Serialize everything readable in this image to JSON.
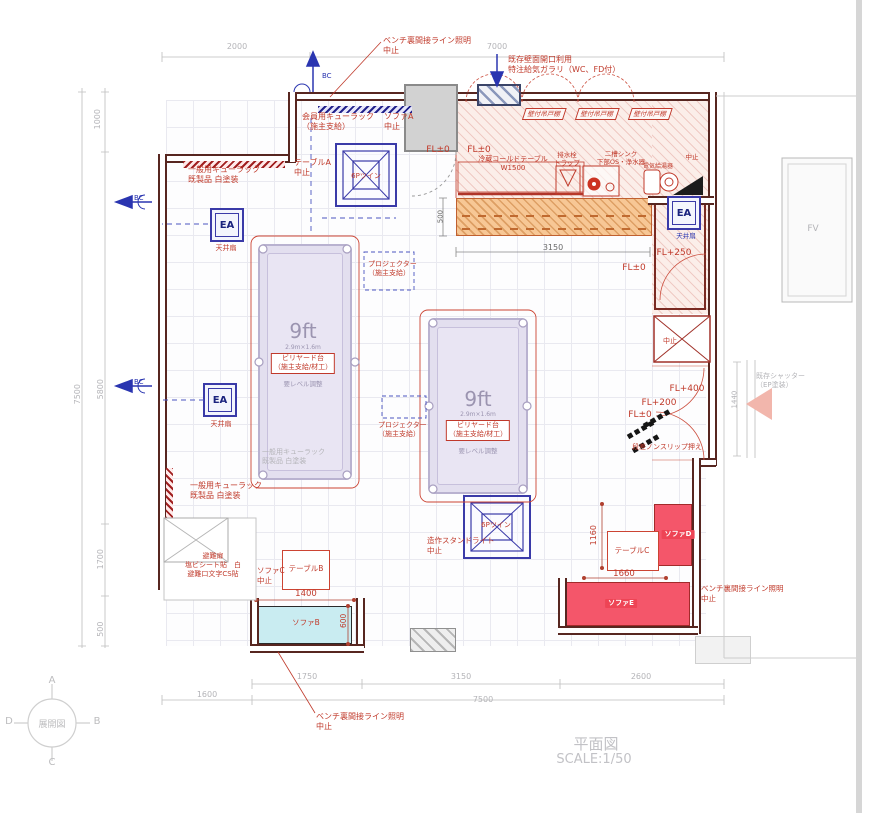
{
  "drawing": {
    "title": "平面図",
    "scale": "SCALE:1/50"
  },
  "compass": {
    "center": "展開図",
    "top": "A",
    "right": "B",
    "bottom": "C",
    "left": "D"
  },
  "symbols": {
    "ea": "EA"
  },
  "colors": {
    "red": "#c03a2b",
    "blue": "#2a35b0",
    "grey": "#b4b4b8",
    "purple": "#9b94b0",
    "dark": "#6a6a6a",
    "white": "#ffffff",
    "wall": "#572620"
  },
  "annotations": [
    {
      "name": "note-bench-light-top",
      "t": "ベンチ裏間接ライン照明\n中止",
      "x": 383,
      "y": 36,
      "c": "red",
      "fs": 8,
      "al": "l"
    },
    {
      "name": "note-vent",
      "t": "既存壁面開口利用\n特注給気ガラリ（WC、FD付）",
      "x": 508,
      "y": 55,
      "c": "red",
      "fs": 8,
      "al": "l"
    },
    {
      "name": "note-cue-member",
      "t": "会員用キューラック\n（施主支給）",
      "x": 302,
      "y": 112,
      "c": "red",
      "fs": 8,
      "al": "l"
    },
    {
      "name": "note-sofa-a",
      "t": "ソファA\n中止",
      "x": 384,
      "y": 112,
      "c": "red",
      "fs": 8,
      "al": "l"
    },
    {
      "name": "note-table-a",
      "t": "テーブルA\n中止",
      "x": 294,
      "y": 158,
      "c": "red",
      "fs": 8,
      "al": "l"
    },
    {
      "name": "label-light-1",
      "t": "6Pツイン",
      "x": 366,
      "y": 172,
      "c": "red",
      "fs": 7
    },
    {
      "name": "note-cue-general-top",
      "t": "一般用キューラック\n既製品 白塗装",
      "x": 188,
      "y": 165,
      "c": "red",
      "fs": 8,
      "al": "l"
    },
    {
      "name": "label-bc-top",
      "t": "BC",
      "x": 322,
      "y": 72,
      "c": "blue",
      "fs": 7,
      "al": "l"
    },
    {
      "name": "label-bc-left-1",
      "t": "BC",
      "x": 134,
      "y": 194,
      "c": "blue",
      "fs": 7,
      "al": "l"
    },
    {
      "name": "label-bc-left-2",
      "t": "BC",
      "x": 134,
      "y": 378,
      "c": "blue",
      "fs": 7,
      "al": "l"
    },
    {
      "name": "label-ceiling-fan-1",
      "t": "天井扇",
      "x": 226,
      "y": 244,
      "c": "red",
      "fs": 7
    },
    {
      "name": "label-ceiling-fan-2",
      "t": "天井扇",
      "x": 221,
      "y": 420,
      "c": "red",
      "fs": 7
    },
    {
      "name": "label-ceiling-fan-3",
      "t": "天井扇",
      "x": 686,
      "y": 232,
      "c": "blue",
      "fs": 6.5
    },
    {
      "name": "label-fl0-entry",
      "t": "FL±0",
      "x": 438,
      "y": 145,
      "c": "red",
      "fs": 9
    },
    {
      "name": "label-fl0-kitchen",
      "t": "FL±0",
      "x": 479,
      "y": 145,
      "c": "red",
      "fs": 9
    },
    {
      "name": "label-cold-table",
      "t": "冷蔵コールドテーブル\nW1500",
      "x": 513,
      "y": 155,
      "c": "red",
      "fs": 7
    },
    {
      "name": "label-cabinet-1",
      "t": "壁付吊戸棚",
      "x": 544,
      "y": 108,
      "c": "red",
      "fs": 6.5,
      "cls": "cab"
    },
    {
      "name": "label-cabinet-2",
      "t": "壁付吊戸棚",
      "x": 597,
      "y": 108,
      "c": "red",
      "fs": 6.5,
      "cls": "cab"
    },
    {
      "name": "label-cabinet-3",
      "t": "壁付吊戸棚",
      "x": 650,
      "y": 108,
      "c": "red",
      "fs": 6.5,
      "cls": "cab"
    },
    {
      "name": "label-drain-trap",
      "t": "排水栓\nトラップ",
      "x": 567,
      "y": 151,
      "c": "red",
      "fs": 6.5
    },
    {
      "name": "label-sink",
      "t": "二槽シンク\n下部OS・浄水器",
      "x": 621,
      "y": 150,
      "c": "red",
      "fs": 6.5
    },
    {
      "name": "label-water-heater",
      "t": "電気給湯器",
      "x": 658,
      "y": 163,
      "c": "red",
      "fs": 6
    },
    {
      "name": "note-stop-topright",
      "t": "中止",
      "x": 692,
      "y": 153,
      "c": "red",
      "fs": 6.5
    },
    {
      "name": "label-fl250",
      "t": "FL+250",
      "x": 674,
      "y": 248,
      "c": "red",
      "fs": 9
    },
    {
      "name": "label-fl0-mid",
      "t": "FL±0",
      "x": 634,
      "y": 263,
      "c": "red",
      "fs": 9
    },
    {
      "name": "dim-3150-counter",
      "t": "3150",
      "x": 553,
      "y": 243,
      "c": "dark",
      "fs": 8
    },
    {
      "name": "dim-500-counter",
      "t": "500",
      "x": 441,
      "y": 212,
      "c": "dark",
      "fs": 7,
      "rot": -90
    },
    {
      "name": "note-projector-1",
      "t": "プロジェクター\n（施主支給）",
      "x": 368,
      "y": 260,
      "c": "red",
      "fs": 7,
      "al": "l"
    },
    {
      "name": "note-projector-2",
      "t": "プロジェクター\n（施主支給）",
      "x": 378,
      "y": 421,
      "c": "red",
      "fs": 7,
      "al": "l"
    },
    {
      "name": "table1-9ft",
      "t": "9ft",
      "x": 303,
      "y": 318,
      "c": "purple",
      "fs": 20
    },
    {
      "name": "table1-size",
      "t": "2.9m×1.6m",
      "x": 303,
      "y": 344,
      "c": "purple",
      "fs": 6
    },
    {
      "name": "table1-badge",
      "t": "ビリヤード台\n（施主支給/材工）",
      "x": 303,
      "y": 353,
      "c": "red",
      "fs": 7,
      "cls": "badge"
    },
    {
      "name": "table1-level",
      "t": "要レベル調整",
      "x": 303,
      "y": 380,
      "c": "purple",
      "fs": 6.5
    },
    {
      "name": "table2-9ft",
      "t": "9ft",
      "x": 478,
      "y": 386,
      "c": "purple",
      "fs": 20
    },
    {
      "name": "table2-size",
      "t": "2.9m×1.6m",
      "x": 478,
      "y": 411,
      "c": "purple",
      "fs": 6
    },
    {
      "name": "table2-badge",
      "t": "ビリヤード台\n（施主支給/材工）",
      "x": 478,
      "y": 420,
      "c": "red",
      "fs": 7,
      "cls": "badge"
    },
    {
      "name": "table2-level",
      "t": "要レベル調整",
      "x": 478,
      "y": 447,
      "c": "purple",
      "fs": 6.5
    },
    {
      "name": "note-cue-grey-mid",
      "t": "一般用キューラック\n既製品 白塗装",
      "x": 262,
      "y": 448,
      "c": "grey",
      "fs": 7,
      "al": "l"
    },
    {
      "name": "label-fl400",
      "t": "FL+400",
      "x": 687,
      "y": 384,
      "c": "red",
      "fs": 9
    },
    {
      "name": "label-fl200",
      "t": "FL+200",
      "x": 659,
      "y": 398,
      "c": "red",
      "fs": 9
    },
    {
      "name": "label-fl0-stair",
      "t": "FL±0",
      "x": 640,
      "y": 410,
      "c": "red",
      "fs": 9
    },
    {
      "name": "label-nonslip",
      "t": "段差ノンスリップ押え",
      "x": 667,
      "y": 443,
      "c": "red",
      "fs": 7
    },
    {
      "name": "note-shutter",
      "t": "既存シャッター\n（EP塗装）",
      "x": 756,
      "y": 372,
      "c": "grey",
      "fs": 7,
      "al": "l"
    },
    {
      "name": "dim-1440",
      "t": "1440",
      "x": 735,
      "y": 395,
      "c": "grey",
      "fs": 7,
      "rot": -90
    },
    {
      "name": "label-fv",
      "t": "FV",
      "x": 813,
      "y": 224,
      "c": "grey",
      "fs": 9
    },
    {
      "name": "note-cue-general-bottom",
      "t": "一般用キューラック\n既製品 白塗装",
      "x": 190,
      "y": 481,
      "c": "red",
      "fs": 8,
      "al": "l"
    },
    {
      "name": "note-escape-door",
      "t": "避難扉\n塩ビシート貼　白\n避難口文字CS貼",
      "x": 213,
      "y": 552,
      "c": "red",
      "fs": 7
    },
    {
      "name": "note-sofa-c",
      "t": "ソファC\n中止",
      "x": 257,
      "y": 566,
      "c": "red",
      "fs": 7.5,
      "al": "l"
    },
    {
      "name": "label-table-b",
      "t": "テーブルB",
      "x": 306,
      "y": 564,
      "c": "red",
      "fs": 7.5
    },
    {
      "name": "dim-1400",
      "t": "1400",
      "x": 306,
      "y": 589,
      "c": "red",
      "fs": 8.5
    },
    {
      "name": "label-sofa-b",
      "t": "ソファB",
      "x": 306,
      "y": 618,
      "c": "red",
      "fs": 7.5
    },
    {
      "name": "dim-600",
      "t": "600",
      "x": 344,
      "y": 616,
      "c": "red",
      "fs": 7.5,
      "rot": -90
    },
    {
      "name": "note-standlight",
      "t": "造作スタンドライト\n中止",
      "x": 427,
      "y": 536,
      "c": "red",
      "fs": 7.5,
      "al": "l"
    },
    {
      "name": "label-light-2",
      "t": "6Pツイン",
      "x": 496,
      "y": 521,
      "c": "red",
      "fs": 7
    },
    {
      "name": "label-table-c",
      "t": "テーブルC",
      "x": 632,
      "y": 546,
      "c": "red",
      "fs": 7.5
    },
    {
      "name": "dim-1160",
      "t": "1160",
      "x": 594,
      "y": 530,
      "c": "red",
      "fs": 8,
      "rot": -90
    },
    {
      "name": "dim-1660",
      "t": "1660",
      "x": 624,
      "y": 569,
      "c": "red",
      "fs": 8.5
    },
    {
      "name": "label-sofa-d",
      "t": "ソファD",
      "x": 678,
      "y": 530,
      "c": "white",
      "fs": 7,
      "cls": "onred"
    },
    {
      "name": "label-sofa-e",
      "t": "ソファE",
      "x": 621,
      "y": 599,
      "c": "white",
      "fs": 7,
      "cls": "onred"
    },
    {
      "name": "note-bench-light-right",
      "t": "ベンチ裏間接ライン照明\n中止",
      "x": 701,
      "y": 584,
      "c": "red",
      "fs": 7.5,
      "al": "l"
    },
    {
      "name": "note-bench-light-bottom",
      "t": "ベンチ裏間接ライン照明\n中止",
      "x": 316,
      "y": 712,
      "c": "red",
      "fs": 8,
      "al": "l"
    },
    {
      "name": "note-stop-xbox",
      "t": "中止",
      "x": 670,
      "y": 337,
      "c": "red",
      "fs": 7
    },
    {
      "name": "dim-2000",
      "t": "2000",
      "x": 237,
      "y": 42,
      "c": "grey",
      "fs": 8
    },
    {
      "name": "dim-7000",
      "t": "7000",
      "x": 497,
      "y": 42,
      "c": "grey",
      "fs": 8
    },
    {
      "name": "dim-1000",
      "t": "1000",
      "x": 98,
      "y": 114,
      "c": "grey",
      "fs": 8,
      "rot": -90
    },
    {
      "name": "dim-5800",
      "t": "5800",
      "x": 101,
      "y": 384,
      "c": "grey",
      "fs": 8,
      "rot": -90
    },
    {
      "name": "dim-7500-left",
      "t": "7500",
      "x": 78,
      "y": 389,
      "c": "grey",
      "fs": 8,
      "rot": -90
    },
    {
      "name": "dim-1700",
      "t": "1700",
      "x": 101,
      "y": 554,
      "c": "grey",
      "fs": 8,
      "rot": -90
    },
    {
      "name": "dim-500-left",
      "t": "500",
      "x": 101,
      "y": 624,
      "c": "grey",
      "fs": 8,
      "rot": -90
    },
    {
      "name": "dim-1750",
      "t": "1750",
      "x": 307,
      "y": 672,
      "c": "grey",
      "fs": 8
    },
    {
      "name": "dim-3150-bottom",
      "t": "3150",
      "x": 461,
      "y": 672,
      "c": "grey",
      "fs": 8
    },
    {
      "name": "dim-2600",
      "t": "2600",
      "x": 641,
      "y": 672,
      "c": "grey",
      "fs": 8
    },
    {
      "name": "dim-1600",
      "t": "1600",
      "x": 207,
      "y": 690,
      "c": "grey",
      "fs": 8
    },
    {
      "name": "dim-7500-bottom",
      "t": "7500",
      "x": 483,
      "y": 695,
      "c": "grey",
      "fs": 8
    }
  ]
}
